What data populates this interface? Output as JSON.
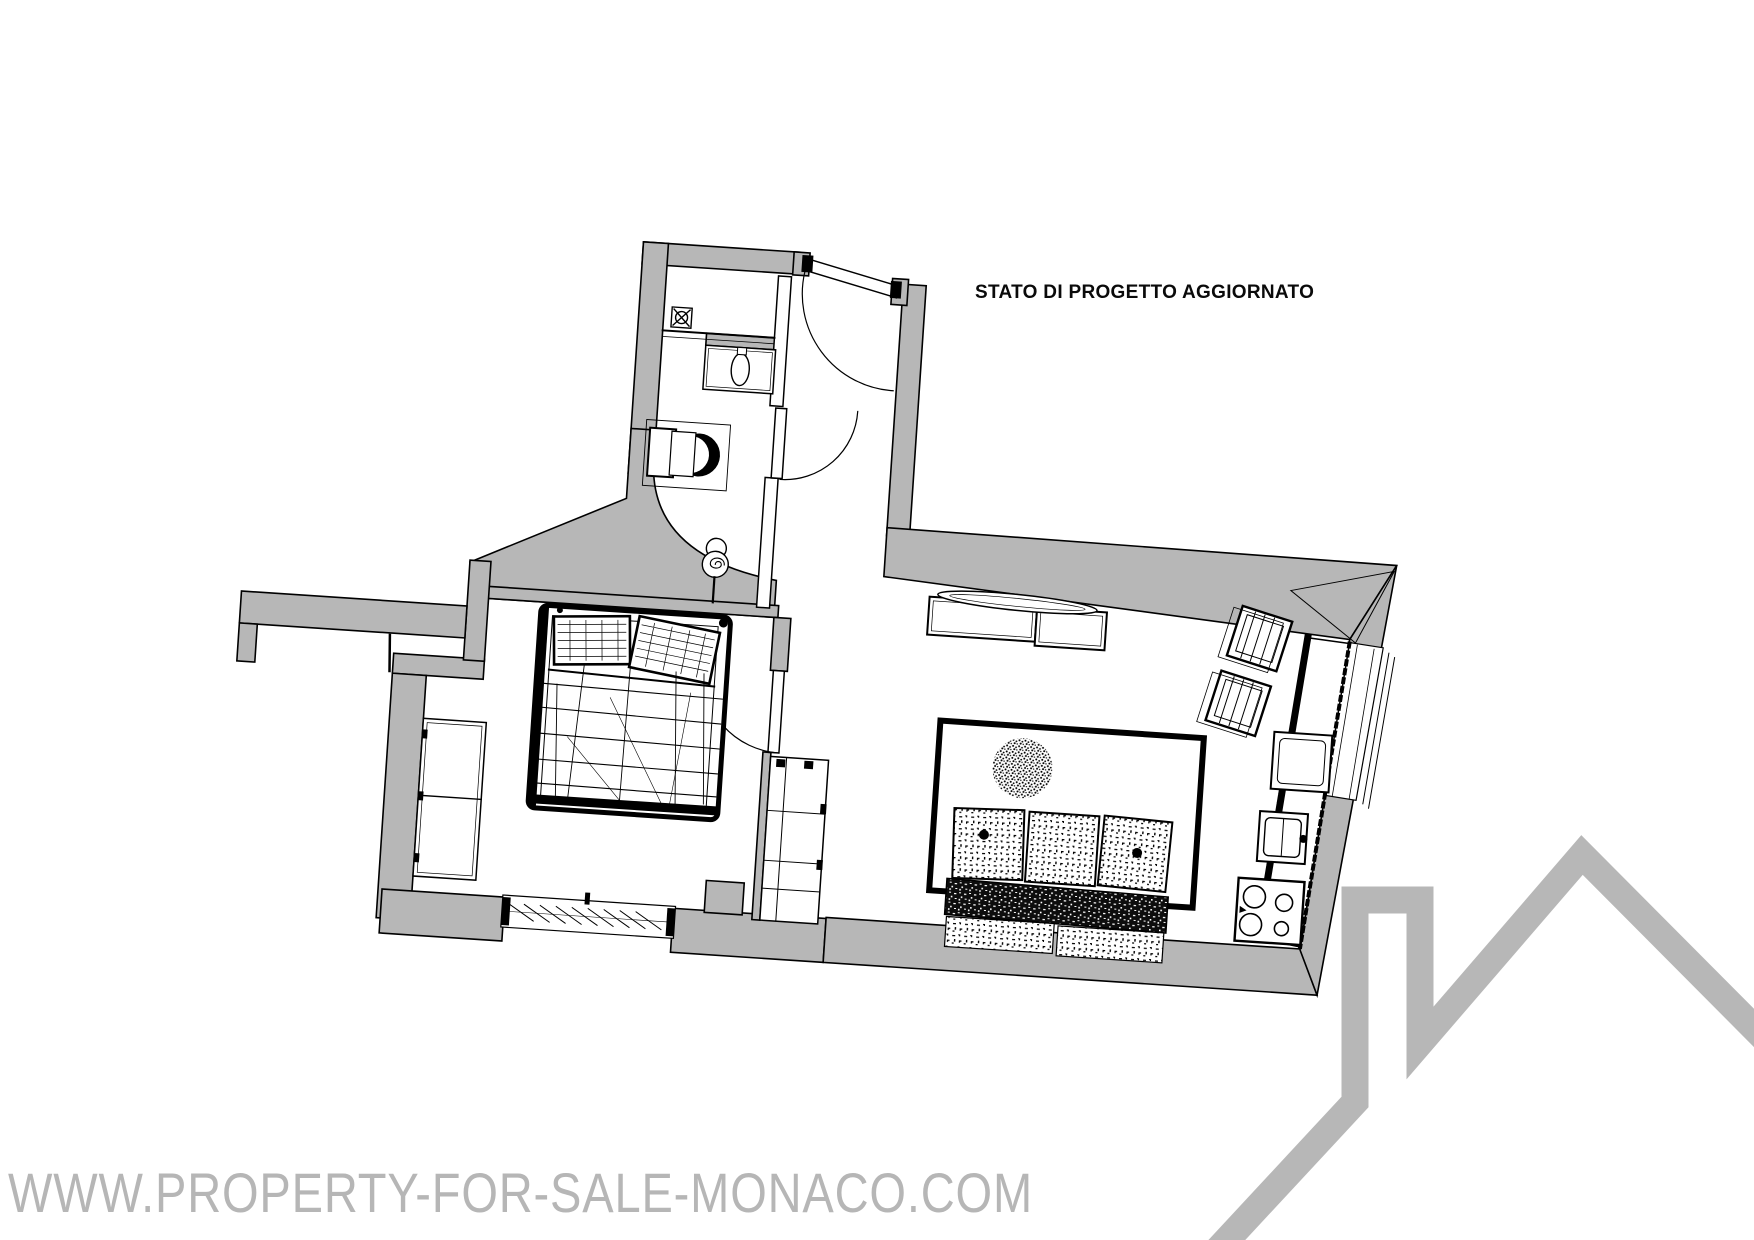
{
  "header": {
    "title": "STATO DI PROGETTO AGGIORNATO"
  },
  "watermark": {
    "text": "WWW.PROPERTY-FOR-SALE-MONACO.COM",
    "color": "#b6b6b6"
  },
  "branding": {
    "logo": "house-roof-logo",
    "color": "#b7b7b7"
  },
  "floorplan": {
    "wall_color": "#b7b7b7",
    "line_color": "#000000",
    "rotation_deg": 3.8,
    "rooms": [
      "bathroom",
      "hallway",
      "bedroom",
      "living-room",
      "kitchen"
    ],
    "fixtures": {
      "bathroom": [
        "shower",
        "shower-drain",
        "washbasin",
        "toilet",
        "pedestal-basin"
      ],
      "bedroom": [
        "double-bed",
        "pillow",
        "pillow",
        "wardrobe",
        "louvered-window"
      ],
      "living_room": [
        "sideboard",
        "tv-console",
        "rug",
        "plant",
        "sofa-3-seats"
      ],
      "kitchen": [
        "chair",
        "chair",
        "counter",
        "cabinet",
        "sink",
        "stove-4-burners",
        "window"
      ],
      "doors": [
        "entrance-door",
        "bathroom-door",
        "bedroom-door"
      ]
    }
  }
}
